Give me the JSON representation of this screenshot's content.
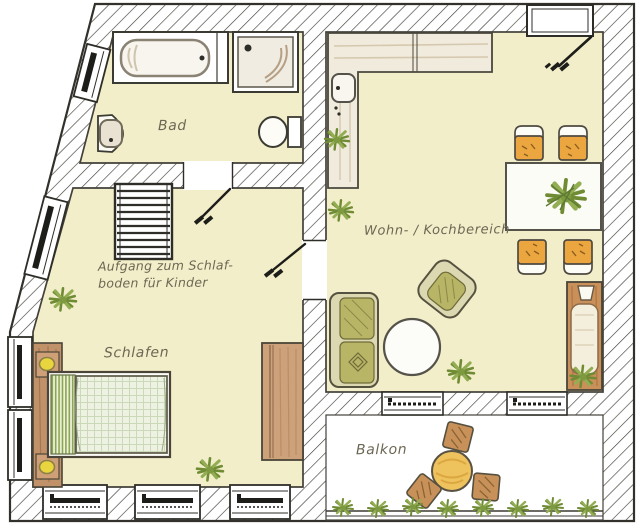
{
  "plan": {
    "kind": "apartment-floor-plan",
    "style": "hand-drawn"
  },
  "rooms": {
    "bad": {
      "label": "Bad"
    },
    "schlafen": {
      "label": "Schlafen"
    },
    "wohn": {
      "label": "Wohn- / Kochbereich"
    },
    "balkon": {
      "label": "Balkon"
    }
  },
  "annotations": {
    "loft_stairs": {
      "line1": "Aufgang zum Schlaf-",
      "line2": "boden für Kinder"
    }
  },
  "colors": {
    "floor": "#f2eec9",
    "balcony_floor": "#ffffff",
    "wall_hatch_line": "#403e37",
    "outline": "#32312b",
    "wood": "#c1926a",
    "chair_orange": "#eca63f",
    "sofa_olive": "#b9b566",
    "plant_green": "#7d9a41",
    "lamp_yellow": "#e9d63f",
    "balcony_table_yellow": "#eec25d",
    "label_text": "#6c6754"
  },
  "furniture": {
    "bad": [
      "bathtub",
      "shower",
      "washbasin",
      "toilet"
    ],
    "schlafen": [
      "loft-stairs",
      "double-bed",
      "headboard-lamps",
      "wardrobe",
      "plants"
    ],
    "wohn": [
      "l-kitchen-counter",
      "kitchen-sink",
      "dining-table",
      "four-chairs",
      "loveseat",
      "armchair",
      "round-coffee-table",
      "daybed",
      "spotlight",
      "plants"
    ],
    "balkon": [
      "round-table",
      "three-stools",
      "plant-row"
    ]
  }
}
